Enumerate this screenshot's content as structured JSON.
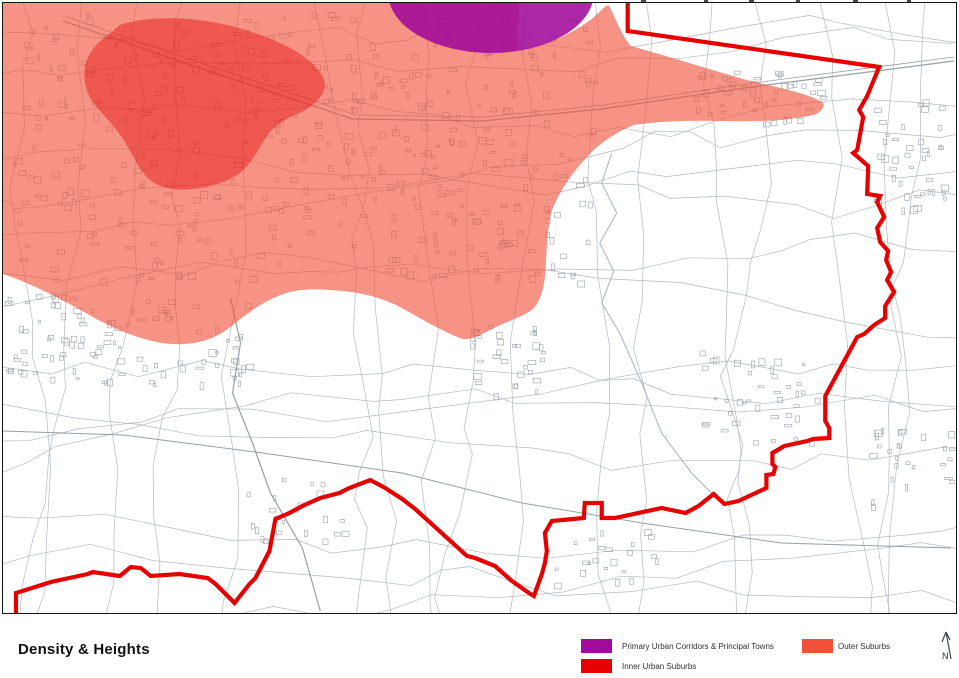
{
  "title": "Density & Heights",
  "legend": {
    "items": [
      {
        "id": "primary-urban",
        "label": "Primary Urban Corridors & Principal Towns",
        "color": "#a10a9b"
      },
      {
        "id": "inner-urban",
        "label": "Inner Urban Suburbs",
        "color": "#e60000"
      },
      {
        "id": "outer-suburbs",
        "label": "Outer Suburbs",
        "color": "#f0503a"
      }
    ]
  },
  "north_arrow": {
    "label": "N"
  },
  "map": {
    "boundary_color": "#e60000",
    "base_line_color": "#b4b9bf",
    "building_line_color": "#9aa0a6"
  }
}
